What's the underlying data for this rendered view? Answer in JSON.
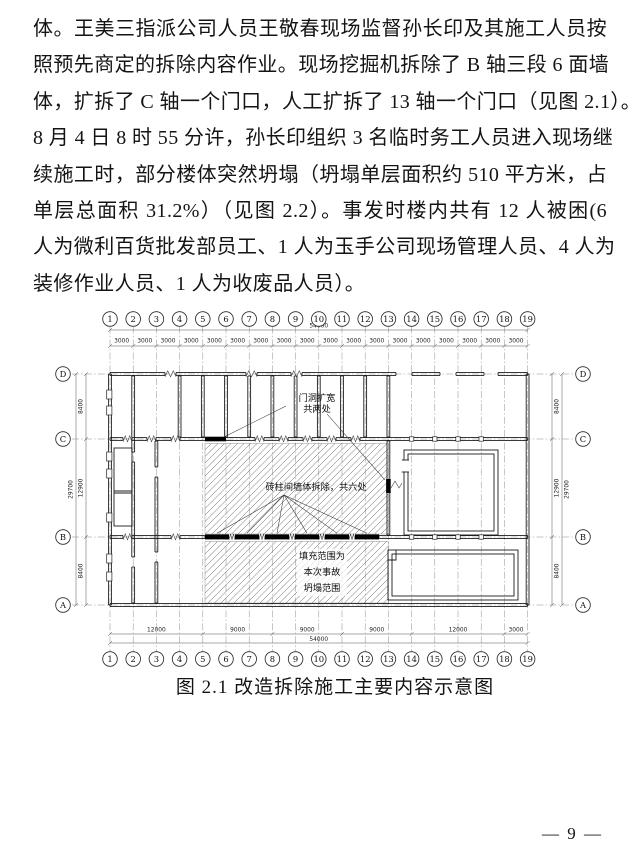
{
  "page": {
    "number": "— 9 —"
  },
  "body_text": {
    "lines": [
      "体。王美三指派公司人员王敬春现场监督孙长印及其施工人员按",
      "照预先商定的拆除内容作业。现场挖掘机拆除了 B 轴三段 6 面墙",
      "体，扩拆了 C 轴一个门口，人工扩拆了 13 轴一个门口（见图 2.1）。",
      "8 月 4 日 8 时 55 分许，孙长印组织 3 名临时务工人员进入现场继",
      "续施工时，部分楼体突然坍塌（坍塌单层面积约 510 平方米，占",
      "单层总面积 31.2%）（见图 2.2）。事发时楼内共有 12 人被困(6",
      "人为微利百货批发部员工、1 人为玉手公司现场管理人员、4 人为",
      "装修作业人员、1 人为收废品人员）。"
    ]
  },
  "figure": {
    "caption": "图 2.1 改造拆除施工主要内容示意图",
    "column_axes": [
      "1",
      "2",
      "3",
      "4",
      "5",
      "6",
      "7",
      "8",
      "9",
      "10",
      "11",
      "12",
      "13",
      "14",
      "15",
      "16",
      "17",
      "18",
      "19"
    ],
    "row_axes": [
      "D",
      "C",
      "B",
      "A"
    ],
    "dims": {
      "total_width": "54000",
      "bay_width": "3000",
      "bottom_bays": [
        "12000",
        "9000",
        "9000",
        "9000",
        "12000",
        "3000"
      ],
      "side_rows": [
        "8400",
        "12900",
        "8400"
      ],
      "total_height": "29700"
    },
    "annotations": {
      "door_widen": [
        "门洞扩宽",
        "共两处"
      ],
      "wall_demolish": "砖柱间墙体拆除，共六处",
      "collapse_fill": [
        "填充范围为",
        "本次事故",
        "坍塌范围"
      ]
    }
  }
}
